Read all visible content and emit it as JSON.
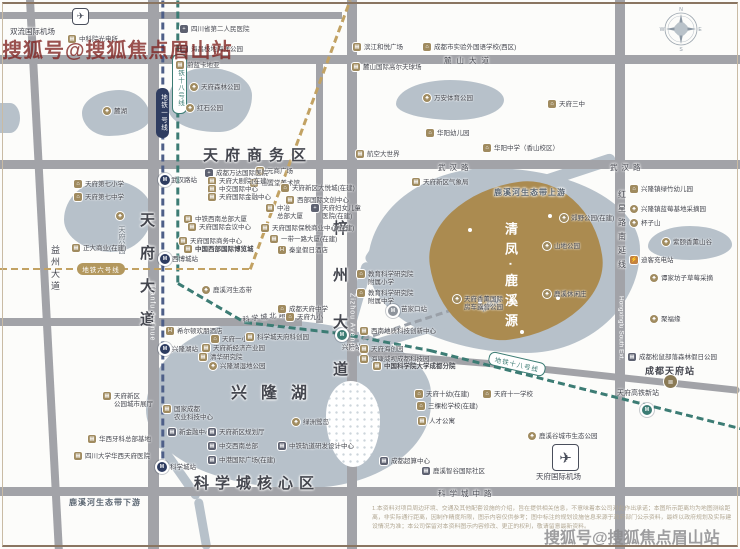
{
  "watermark_top": "搜狐号@搜狐焦点眉山站",
  "watermark_bottom": "搜狐号@搜狐焦点眉山站",
  "compass": {
    "n": "N",
    "e": "E",
    "s": "S",
    "w": "W",
    "x": 658,
    "y": 4
  },
  "property": {
    "name": "清凤·鹿溪源",
    "x": 430,
    "y": 183,
    "w": 172,
    "h": 155,
    "color": "#ab8b50",
    "dots": [
      [
        468,
        228
      ],
      [
        548,
        214
      ],
      [
        478,
        300
      ],
      [
        556,
        296
      ],
      [
        520,
        330
      ]
    ]
  },
  "titles": [
    {
      "t": "天府商务区",
      "x": 203,
      "y": 144,
      "s": 15,
      "ls": 7,
      "b": 1
    },
    {
      "t": "兴隆湖",
      "x": 231,
      "y": 379,
      "s": 16,
      "ls": 14,
      "b": 1
    },
    {
      "t": "科学城核心区",
      "x": 194,
      "y": 472,
      "s": 15,
      "ls": 6,
      "b": 1
    }
  ],
  "road_labels": [
    {
      "t": "麓山大道",
      "x": 444,
      "y": 55,
      "s": 7.5,
      "ls": 5
    },
    {
      "t": "武汉路",
      "x": 438,
      "y": 161.5,
      "s": 7.5,
      "ls": 4
    },
    {
      "t": "武汉路",
      "x": 610,
      "y": 161.5,
      "s": 7.5,
      "ls": 4
    },
    {
      "t": "科学城中路",
      "x": 438,
      "y": 488,
      "s": 7.5,
      "ls": 4
    },
    {
      "t": "科学城北路",
      "x": 242,
      "y": 315,
      "s": 7,
      "ls": 2,
      "rot": -7
    },
    {
      "t": "益州大道",
      "x": 49,
      "y": 245,
      "s": 9,
      "ls": 3,
      "vert": 1
    },
    {
      "t": "天府大道",
      "x": 136,
      "y": 212,
      "s": 15,
      "ls": 18,
      "vert": 1,
      "b": 1
    },
    {
      "t": "Tianfu Avenue",
      "x": 148.5,
      "y": 284,
      "s": 7,
      "vert": 1,
      "ls": 1,
      "c": "#ffffff"
    },
    {
      "t": "梓州大道",
      "x": 329,
      "y": 220,
      "s": 15,
      "ls": 32,
      "vert": 1,
      "b": 1
    },
    {
      "t": "Zizhou Avenue",
      "x": 348.5,
      "y": 293,
      "s": 7,
      "vert": 1,
      "ls": 1,
      "c": "#ffffff"
    },
    {
      "t": "红星路南延线",
      "x": 616.5,
      "y": 190,
      "s": 8,
      "ls": 6,
      "vert": 1
    },
    {
      "t": "Hongxinglu South Ext.",
      "x": 617.5,
      "y": 296,
      "s": 6.5,
      "vert": 1,
      "c": "#ffffff"
    },
    {
      "t": "鹿溪河生态带上游",
      "x": 494,
      "y": 187,
      "s": 8,
      "ls": 1,
      "b": 1,
      "c": "#5b6671"
    },
    {
      "t": "鹿溪河生态带下游",
      "x": 69,
      "y": 497,
      "s": 8,
      "ls": 1,
      "b": 1,
      "c": "#5b6671"
    },
    {
      "t": "东风渠",
      "x": 479,
      "y": 306,
      "s": 7,
      "rot": -30,
      "c": "#6a737c"
    },
    {
      "t": "天府公园",
      "x": 116,
      "y": 226,
      "s": 7,
      "vert": 1,
      "c": "#6a737c"
    },
    {
      "t": "双流国际机场",
      "x": 10,
      "y": 26,
      "s": 7.5
    },
    {
      "t": "天府国际机场",
      "x": 536,
      "y": 471,
      "s": 7.5
    },
    {
      "t": "成都天府站",
      "x": 645,
      "y": 364,
      "s": 9,
      "ls": 1,
      "b": 1
    },
    {
      "t": "天府高铁新站",
      "x": 617,
      "y": 388,
      "s": 7
    }
  ],
  "parks": [
    {
      "x": 82,
      "y": 90,
      "w": 68,
      "h": 46,
      "r": "55% 45% 60% 40% / 50% 60% 40% 50%"
    },
    {
      "x": 0,
      "y": 103,
      "w": 20,
      "h": 30,
      "r": "0 60% 60% 0"
    },
    {
      "x": 168,
      "y": 68,
      "w": 84,
      "h": 64,
      "r": "45% 55% 40% 60% / 55% 45% 60% 40%"
    },
    {
      "x": 396,
      "y": 80,
      "w": 108,
      "h": 40,
      "r": "50% 50% 45% 55% / 60% 50% 50% 40%"
    },
    {
      "x": 648,
      "y": 226,
      "w": 84,
      "h": 34,
      "r": "50% 50% 50% 50% / 60% 55% 45% 40%"
    },
    {
      "x": 368,
      "y": 168,
      "w": 272,
      "h": 185,
      "r": "45% 55% 42% 58% / 52% 44% 56% 48%"
    },
    {
      "x": 64,
      "y": 180,
      "w": 88,
      "h": 72,
      "r": "50% 50% 45% 55% / 55% 45% 55% 45%"
    },
    {
      "x": 146,
      "y": 320,
      "w": 285,
      "h": 168,
      "r": "42% 58% 45% 55% / 55% 45% 52% 48%"
    }
  ],
  "island": {
    "x": 326,
    "y": 381,
    "w": 54,
    "h": 86,
    "r": "45% 55% 50% 50% / 40% 45% 55% 60%"
  },
  "waterways": [
    {
      "x1": 615,
      "y1": 158,
      "x2": 500,
      "y2": 196,
      "t": 12
    },
    {
      "x1": 500,
      "y1": 196,
      "x2": 398,
      "y2": 216,
      "t": 12
    },
    {
      "x1": 398,
      "y1": 216,
      "x2": 368,
      "y2": 262,
      "t": 11
    },
    {
      "x1": 368,
      "y1": 262,
      "x2": 348,
      "y2": 332,
      "t": 11
    },
    {
      "x1": 330,
      "y1": 358,
      "x2": 580,
      "y2": 282,
      "t": 10
    },
    {
      "x1": 498,
      "y1": 286,
      "x2": 486,
      "y2": 346,
      "t": 9
    },
    {
      "x1": 150,
      "y1": 408,
      "x2": 163,
      "y2": 448,
      "t": 9
    },
    {
      "x1": 163,
      "y1": 448,
      "x2": 198,
      "y2": 498,
      "t": 9
    },
    {
      "x1": 198,
      "y1": 498,
      "x2": 207,
      "y2": 549,
      "t": 9
    }
  ],
  "roads": [
    {
      "x": 0,
      "y": 12,
      "w": 342,
      "h": 7
    },
    {
      "x": 0,
      "y": 55,
      "w": 740,
      "h": 9
    },
    {
      "x": 0,
      "y": 160,
      "w": 740,
      "h": 9
    },
    {
      "x": 0,
      "y": 318,
      "w": 302,
      "h": 8
    },
    {
      "x": 0,
      "y": 487,
      "w": 740,
      "h": 9
    },
    {
      "x": 26,
      "y": 0,
      "w": 8,
      "h": 556,
      "rot": -3
    },
    {
      "x": 148,
      "y": 0,
      "w": 11,
      "h": 549
    },
    {
      "x": 347,
      "y": 0,
      "w": 10,
      "h": 549
    },
    {
      "x": 316,
      "y": 58,
      "w": 7,
      "h": 265
    },
    {
      "x": 615,
      "y": 0,
      "w": 10,
      "h": 549
    }
  ],
  "road_bands": [
    {
      "x1": 355,
      "y1": 352,
      "x2": 500,
      "y2": 364,
      "t": 7
    },
    {
      "x1": 500,
      "y1": 364,
      "x2": 740,
      "y2": 390,
      "t": 7
    }
  ],
  "metro_lines": [
    {
      "name": "line-1",
      "color": "#4e5f88",
      "pts": [
        [
          163,
          0
        ],
        [
          163,
          473
        ]
      ]
    },
    {
      "name": "line-18",
      "color": "#3c7c74",
      "pts": [
        [
          178,
          0
        ],
        [
          178,
          283
        ],
        [
          245,
          322
        ],
        [
          340,
          333
        ],
        [
          430,
          350
        ],
        [
          740,
          428
        ]
      ]
    },
    {
      "name": "line-6",
      "color": "#c2a263",
      "pts": [
        [
          0,
          269
        ],
        [
          250,
          269
        ],
        [
          350,
          0
        ]
      ]
    },
    {
      "name": "rail",
      "color": "#9aa0a8",
      "pts": [
        [
          352,
          342
        ],
        [
          478,
          301
        ]
      ]
    }
  ],
  "stations": [
    {
      "x": 163,
      "y": 178,
      "c": "#2e3c60",
      "label": "武汉路站",
      "lx": 171,
      "ly": 174
    },
    {
      "x": 163,
      "y": 257,
      "c": "#2e3c60",
      "label": "西博城站",
      "lx": 172,
      "ly": 253
    },
    {
      "x": 163,
      "y": 347,
      "c": "#2e3c60",
      "label": "兴隆湖站",
      "lx": 172,
      "ly": 343
    },
    {
      "x": 160,
      "y": 465,
      "c": "#2e3c60",
      "label": "科学城站",
      "lx": 170,
      "ly": 461
    },
    {
      "x": 340,
      "y": 333,
      "c": "#3c7c74",
      "label": "兴隆站",
      "lx": 342,
      "ly": 341
    },
    {
      "x": 391,
      "y": 309,
      "c": "#8d939b",
      "label": "苗家口站",
      "lx": 401,
      "ly": 303
    },
    {
      "x": 645,
      "y": 408,
      "c": "#3c7c74",
      "label": "",
      "lx": 0,
      "ly": 0
    }
  ],
  "badges": [
    {
      "t": "地铁一号线",
      "x": 156,
      "y": 88,
      "w": 13,
      "h": 50,
      "v": "navy",
      "vert": 1
    },
    {
      "t": "地铁十八号线",
      "x": 172,
      "y": 54,
      "w": 13,
      "h": 58,
      "v": "teal",
      "vert": 1
    },
    {
      "t": "地铁六号线",
      "x": 77,
      "y": 263,
      "w": 48,
      "h": 12,
      "v": "gold"
    },
    {
      "t": "地铁十八号线",
      "x": 488,
      "y": 357,
      "w": 56,
      "h": 12,
      "v": "teal",
      "rot": 13
    }
  ],
  "pois": [
    {
      "x": 68,
      "y": 36,
      "t": "bld",
      "n": "中科院光电所"
    },
    {
      "x": 180,
      "y": 26,
      "t": "hosp",
      "n": "四川省第二人民医院"
    },
    {
      "x": 180,
      "y": 46,
      "t": "bld2",
      "n": "海昌极地海洋公园"
    },
    {
      "x": 176,
      "y": 62,
      "t": "bld",
      "n": "蔚蓝卡地亚"
    },
    {
      "x": 190,
      "y": 84,
      "t": "tree",
      "n": "天府森林公园"
    },
    {
      "x": 186,
      "y": 105,
      "t": "tree",
      "n": "红石公园"
    },
    {
      "x": 103,
      "y": 108,
      "t": "tree",
      "n": "麓湖"
    },
    {
      "x": 353,
      "y": 44,
      "t": "bld",
      "n": "滨江和悦广场"
    },
    {
      "x": 423,
      "y": 44,
      "t": "school",
      "n": "成都市实验外国语学校(西区)"
    },
    {
      "x": 352,
      "y": 64,
      "t": "bld",
      "n": "麓山国际高尔夫球场"
    },
    {
      "x": 423,
      "y": 95,
      "t": "tree",
      "n": "万安体育公园"
    },
    {
      "x": 426,
      "y": 130,
      "t": "school",
      "n": "华阳幼儿园"
    },
    {
      "x": 483,
      "y": 145,
      "t": "school",
      "n": "华阳中学（香山校区）"
    },
    {
      "x": 548,
      "y": 101,
      "t": "school",
      "n": "天府三中"
    },
    {
      "x": 356,
      "y": 151,
      "t": "bld",
      "n": "航空大世界"
    },
    {
      "x": 412,
      "y": 179,
      "t": "bld",
      "n": "天府新区气象局"
    },
    {
      "x": 74,
      "y": 181,
      "t": "school",
      "n": "天府第七小学"
    },
    {
      "x": 74,
      "y": 194,
      "t": "school",
      "n": "天府第七中学"
    },
    {
      "x": 72,
      "y": 245,
      "t": "bld",
      "n": "正大商业(在建)"
    },
    {
      "x": 116,
      "y": 213,
      "t": "tree",
      "n": ""
    },
    {
      "x": 256,
      "y": 168,
      "t": "bld",
      "n": "元商广场"
    },
    {
      "x": 250,
      "y": 180,
      "t": "bld",
      "n": "恒置堂美术馆"
    },
    {
      "x": 281,
      "y": 185,
      "t": "school",
      "n": "天府新区大悦城(在建)"
    },
    {
      "x": 286,
      "y": 197,
      "t": "bld",
      "n": "西部国际文创中心"
    },
    {
      "x": 266,
      "y": 205,
      "t": "bld",
      "n": "中冶",
      "sub": "总部大厦"
    },
    {
      "x": 311,
      "y": 205,
      "t": "hosp",
      "n": "天府妇女儿童",
      "sub": "医院(在建)"
    },
    {
      "x": 261,
      "y": 225,
      "t": "bld",
      "n": "天府国际保税商业中心(在建)"
    },
    {
      "x": 270,
      "y": 236,
      "t": "bld",
      "n": "一带一路大厦(在建)"
    },
    {
      "x": 278,
      "y": 247,
      "t": "hotel",
      "n": "秦皇假日酒店"
    },
    {
      "x": 205,
      "y": 170,
      "t": "hosp",
      "n": "成都万达国际医院"
    },
    {
      "x": 208,
      "y": 178,
      "t": "bld",
      "n": "天府大剧院(在建)"
    },
    {
      "x": 208,
      "y": 186,
      "t": "bld",
      "n": "中交国际中心"
    },
    {
      "x": 208,
      "y": 194,
      "t": "bld",
      "n": "天府国际金融中心"
    },
    {
      "x": 184,
      "y": 216,
      "t": "bld",
      "n": "中铁西南总部大厦"
    },
    {
      "x": 188,
      "y": 224,
      "t": "bld",
      "n": "天府国际会议中心"
    },
    {
      "x": 179,
      "y": 238,
      "t": "bld",
      "n": "天府国际商务中心"
    },
    {
      "x": 184,
      "y": 246,
      "t": "bld",
      "n": "中国西部国际博览城",
      "b": 1
    },
    {
      "x": 630,
      "y": 186,
      "t": "school",
      "n": "兴隆镇绿竹幼儿园"
    },
    {
      "x": 630,
      "y": 206,
      "t": "tree",
      "n": "兴隆镇蓝莓基地采摘园"
    },
    {
      "x": 630,
      "y": 220,
      "t": "tree",
      "n": "杯子山"
    },
    {
      "x": 662,
      "y": 239,
      "t": "tree",
      "n": "紫颐香薰山谷"
    },
    {
      "x": 630,
      "y": 257,
      "t": "charge",
      "n": "迪客充电站"
    },
    {
      "x": 650,
      "y": 275,
      "t": "tree",
      "n": "谭家坊子草莓采摘"
    },
    {
      "x": 650,
      "y": 316,
      "t": "tree",
      "n": "聚福缘"
    },
    {
      "x": 628,
      "y": 354,
      "t": "bld2",
      "n": "成都松鼠部落森林假日公园"
    },
    {
      "x": 560,
      "y": 215,
      "t": "tree",
      "n": "郊野公园(在建)"
    },
    {
      "x": 543,
      "y": 243,
      "t": "tree",
      "n": "山地公园"
    },
    {
      "x": 543,
      "y": 291,
      "t": "tree",
      "n": "鹿溪休闲庄"
    },
    {
      "x": 202,
      "y": 287,
      "t": "tree",
      "n": "鹿溪河生态带"
    },
    {
      "x": 357,
      "y": 271,
      "t": "school",
      "n": "教育科学研究院",
      "sub": "附属小学"
    },
    {
      "x": 357,
      "y": 290,
      "t": "school",
      "n": "教育科学研究院",
      "sub": "附属中学"
    },
    {
      "x": 453,
      "y": 296,
      "t": "tree",
      "n": "天府香薰国际",
      "sub": "房车露营公园"
    },
    {
      "x": 166,
      "y": 328,
      "t": "hotel",
      "n": "希尔顿欢朋酒店"
    },
    {
      "x": 211,
      "y": 336,
      "t": "school",
      "n": "天府一小"
    },
    {
      "x": 202,
      "y": 345,
      "t": "bld",
      "n": "天府新经济产业园"
    },
    {
      "x": 199,
      "y": 354,
      "t": "bld",
      "n": "清华研究院"
    },
    {
      "x": 209,
      "y": 363,
      "t": "tree",
      "n": "兴隆湖湿地公园"
    },
    {
      "x": 103,
      "y": 393,
      "t": "bld",
      "n": "天府新区",
      "sub": "公园城市展厅"
    },
    {
      "x": 163,
      "y": 406,
      "t": "bld",
      "n": "国家成都",
      "sub": "农业科技中心"
    },
    {
      "x": 168,
      "y": 429,
      "t": "bld2",
      "n": "新金融中心"
    },
    {
      "x": 208,
      "y": 429,
      "t": "bld2",
      "n": "天府新区规划厅"
    },
    {
      "x": 208,
      "y": 443,
      "t": "bld2",
      "n": "中交西南总部"
    },
    {
      "x": 208,
      "y": 457,
      "t": "bld2",
      "n": "中港国际广场(在建)"
    },
    {
      "x": 88,
      "y": 436,
      "t": "bld",
      "n": "华西牙科总部基地"
    },
    {
      "x": 74,
      "y": 453,
      "t": "bld",
      "n": "四川大学华西天府医院"
    },
    {
      "x": 278,
      "y": 443,
      "t": "bld2",
      "n": "中铁轨道研发设计中心"
    },
    {
      "x": 292,
      "y": 419,
      "t": "tree",
      "n": "绿洲鹭岛"
    },
    {
      "x": 278,
      "y": 306,
      "t": "school",
      "n": "成都天府中学"
    },
    {
      "x": 286,
      "y": 314,
      "t": "school",
      "n": "天府九小"
    },
    {
      "x": 246,
      "y": 334,
      "t": "bld",
      "n": "科学城天府科创园"
    },
    {
      "x": 360,
      "y": 328,
      "t": "bld",
      "n": "西南地质科技创新中心"
    },
    {
      "x": 360,
      "y": 346,
      "t": "bld",
      "n": "天府海创园"
    },
    {
      "x": 360,
      "y": 356,
      "t": "bld",
      "n": "海康威视成都科技园"
    },
    {
      "x": 373,
      "y": 363,
      "t": "bld",
      "n": "中国科学院大学成都分院",
      "b": 1
    },
    {
      "x": 415,
      "y": 391,
      "t": "school",
      "n": "天府十幼(在建)"
    },
    {
      "x": 417,
      "y": 403,
      "t": "school",
      "n": "三棵松学校(在建)"
    },
    {
      "x": 483,
      "y": 391,
      "t": "school",
      "n": "天府十一学校"
    },
    {
      "x": 418,
      "y": 418,
      "t": "bld",
      "n": "人才公寓"
    },
    {
      "x": 380,
      "y": 458,
      "t": "bld2",
      "n": "成都超算中心"
    },
    {
      "x": 422,
      "y": 468,
      "t": "bld2",
      "n": "鹿溪智谷国际社区"
    },
    {
      "x": 528,
      "y": 433,
      "t": "tree",
      "n": "鹿溪谷城市生态公园"
    },
    {
      "x": 664,
      "y": 376,
      "t": "train",
      "n": ""
    }
  ],
  "airports": [
    {
      "x": 72,
      "y": 8,
      "s": 15
    },
    {
      "x": 552,
      "y": 444,
      "s": 25
    }
  ],
  "disclaimer": {
    "x": 372,
    "y": 505,
    "w": 364,
    "lines": [
      "1.本资料对项目周边环境、交通及其他配套设施的介绍，旨在提供相关信息，不意味着本公司对此作出承诺；本图所示距离均为地图测绘距离，非实际通行距离，因制作精度所限，图示内容仅供参考；图中标注的规划设施信息来源于政府部门公示资料，最终以政府规划及实际建设情况为准；本公司保留对本资料图示内容修改、更正的权利，敬请留意最新资料。"
    ]
  }
}
